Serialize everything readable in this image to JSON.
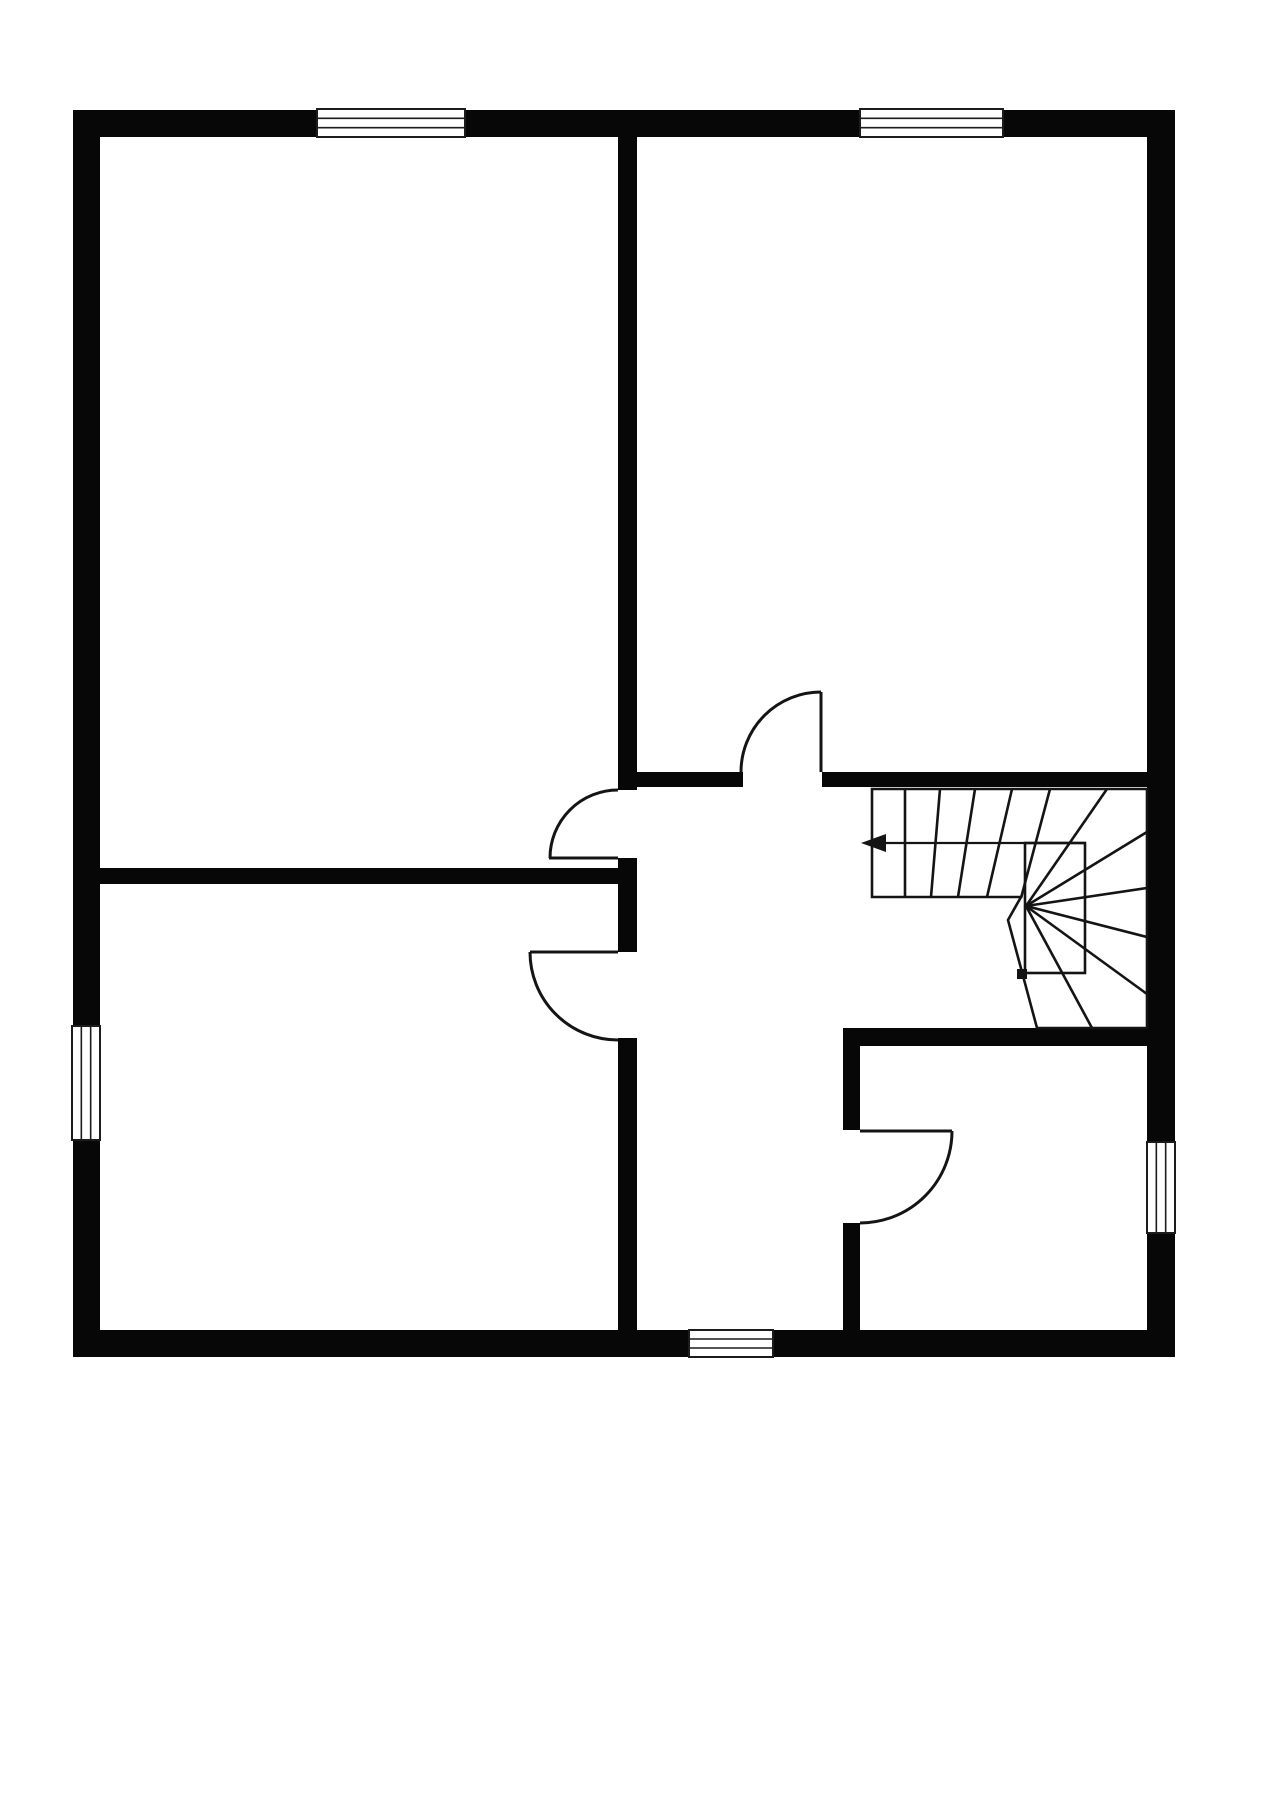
{
  "document": {
    "type": "floor-plan",
    "storey": "single-floor-plan-with-winder-staircase"
  },
  "canvas": {
    "width": 1280,
    "height": 1811,
    "background": "#ffffff",
    "wall_color": "#070707",
    "line_color": "#141414",
    "window_border_color": "#1c1c1c"
  },
  "walls": {
    "outer": [
      {
        "name": "outer-wall-top",
        "x": 73,
        "y": 110,
        "w": 1102,
        "h": 27
      },
      {
        "name": "outer-wall-left",
        "x": 73,
        "y": 110,
        "w": 27,
        "h": 1247
      },
      {
        "name": "outer-wall-right",
        "x": 1147,
        "y": 110,
        "w": 28,
        "h": 1247
      },
      {
        "name": "outer-wall-bottom",
        "x": 73,
        "y": 1330,
        "w": 1102,
        "h": 27
      }
    ],
    "interior": [
      {
        "name": "interior-wall-center-vertical-upper",
        "x": 618,
        "y": 137,
        "w": 19,
        "h": 653
      },
      {
        "name": "interior-wall-center-vertical-stub",
        "x": 618,
        "y": 858,
        "w": 19,
        "h": 94
      },
      {
        "name": "interior-wall-center-vertical-lower",
        "x": 618,
        "y": 1038,
        "w": 19,
        "h": 292
      },
      {
        "name": "interior-wall-left-horizontal",
        "x": 98,
        "y": 868,
        "w": 539,
        "h": 16
      },
      {
        "name": "interior-wall-right-horizontal-west",
        "x": 637,
        "y": 772,
        "w": 106,
        "h": 15
      },
      {
        "name": "interior-wall-right-horizontal-east",
        "x": 822,
        "y": 772,
        "w": 325,
        "h": 15
      },
      {
        "name": "interior-wall-bottomright-room-top",
        "x": 843,
        "y": 1028,
        "w": 304,
        "h": 18
      },
      {
        "name": "interior-wall-bottomright-room-west-upper",
        "x": 843,
        "y": 1028,
        "w": 17,
        "h": 102
      },
      {
        "name": "interior-wall-bottomright-room-west-lower",
        "x": 843,
        "y": 1223,
        "w": 17,
        "h": 107
      }
    ]
  },
  "windows": [
    {
      "name": "window-top-left",
      "x": 317,
      "y": 109,
      "w": 148,
      "h": 28,
      "orientation": "horizontal"
    },
    {
      "name": "window-top-right",
      "x": 860,
      "y": 109,
      "w": 143,
      "h": 28,
      "orientation": "horizontal"
    },
    {
      "name": "window-left",
      "x": 72,
      "y": 1026,
      "w": 28,
      "h": 114,
      "orientation": "vertical"
    },
    {
      "name": "window-right",
      "x": 1147,
      "y": 1142,
      "w": 28,
      "h": 91,
      "orientation": "vertical"
    },
    {
      "name": "window-bottom",
      "x": 689,
      "y": 1330,
      "w": 84,
      "h": 27,
      "orientation": "horizontal"
    }
  ],
  "doors": [
    {
      "name": "door-top-left-room",
      "leaf": [
        [
          549,
          858
        ],
        [
          618,
          858
        ]
      ],
      "arc": {
        "from": [
          550,
          858
        ],
        "to": [
          618,
          790
        ],
        "r": 68,
        "sweep": 1
      }
    },
    {
      "name": "door-bottom-left-room",
      "leaf": [
        [
          530,
          952
        ],
        [
          618,
          952
        ]
      ],
      "arc": {
        "from": [
          530,
          952
        ],
        "to": [
          618,
          1040
        ],
        "r": 88,
        "sweep": 0
      }
    },
    {
      "name": "door-top-right-room",
      "leaf": [
        [
          821,
          692
        ],
        [
          821,
          772
        ]
      ],
      "arc": {
        "from": [
          821,
          692
        ],
        "to": [
          741,
          772
        ],
        "r": 80,
        "sweep": 0
      }
    },
    {
      "name": "door-bottom-right-room",
      "leaf": [
        [
          860,
          1131
        ],
        [
          952,
          1131
        ]
      ],
      "arc": {
        "from": [
          952,
          1131
        ],
        "to": [
          860,
          1223
        ],
        "r": 92,
        "sweep": 1
      }
    }
  ],
  "stairs": {
    "name": "winder-staircase",
    "outline": "M872,789 L1147,789 L1147,1028 L1037,1028 L1008,920 L1021,897 L872,897 Z",
    "well_rect": {
      "x": 1025,
      "y": 843,
      "w": 60,
      "h": 130
    },
    "treads": [
      [
        [
          905,
          789
        ],
        [
          905,
          897
        ]
      ],
      [
        [
          940,
          789
        ],
        [
          931,
          897
        ]
      ],
      [
        [
          975,
          789
        ],
        [
          958,
          897
        ]
      ],
      [
        [
          1012,
          789
        ],
        [
          987,
          897
        ]
      ],
      [
        [
          1050,
          789
        ],
        [
          1021,
          898
        ]
      ],
      [
        [
          1107,
          789
        ],
        [
          1026,
          906
        ]
      ],
      [
        [
          1026,
          906
        ],
        [
          1147,
          832
        ]
      ],
      [
        [
          1026,
          906
        ],
        [
          1147,
          888
        ]
      ],
      [
        [
          1026,
          906
        ],
        [
          1147,
          937
        ]
      ],
      [
        [
          1026,
          906
        ],
        [
          1147,
          994
        ]
      ],
      [
        [
          1026,
          906
        ],
        [
          1092,
          1028
        ]
      ]
    ],
    "newel_post": {
      "x": 1017,
      "y": 969,
      "w": 10,
      "h": 10
    },
    "direction_arrow": {
      "line": [
        [
          1085,
          843
        ],
        [
          878,
          843
        ]
      ],
      "head": [
        [
          861,
          843
        ],
        [
          886,
          834
        ],
        [
          886,
          852
        ]
      ]
    }
  }
}
